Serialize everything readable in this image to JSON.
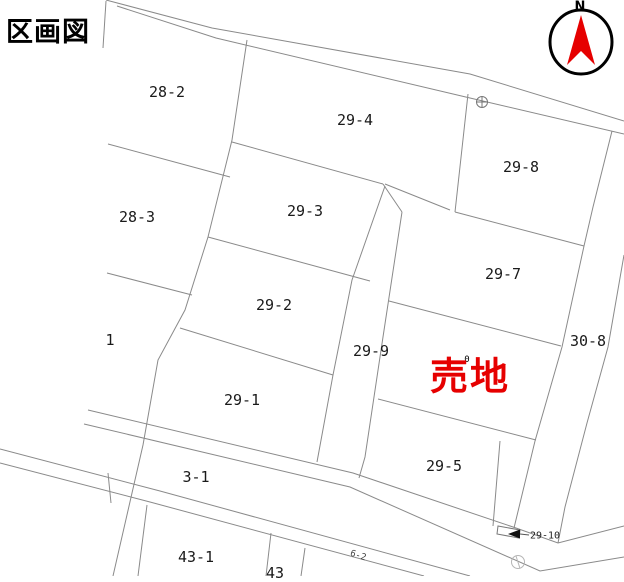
{
  "title": "区画図",
  "compass": {
    "north_label": "N",
    "arrow_color": "#e60000",
    "ring_color": "#000000"
  },
  "sale": {
    "label": "売地",
    "color": "#e60000",
    "hidden_mark": "0"
  },
  "lots": [
    {
      "label": "28-2",
      "x": 167,
      "y": 92
    },
    {
      "label": "29-4",
      "x": 355,
      "y": 120
    },
    {
      "label": "29-8",
      "x": 521,
      "y": 167
    },
    {
      "label": "28-3",
      "x": 137,
      "y": 217
    },
    {
      "label": "29-3",
      "x": 305,
      "y": 211
    },
    {
      "label": "29-7",
      "x": 503,
      "y": 274
    },
    {
      "label": "29-2",
      "x": 274,
      "y": 305
    },
    {
      "label": "1",
      "x": 110,
      "y": 340
    },
    {
      "label": "29-9",
      "x": 371,
      "y": 351
    },
    {
      "label": "30-8",
      "x": 588,
      "y": 341
    },
    {
      "label": "29-1",
      "x": 242,
      "y": 400
    },
    {
      "label": "29-5",
      "x": 444,
      "y": 466
    },
    {
      "label": "3-1",
      "x": 196,
      "y": 477
    },
    {
      "label": "43-1",
      "x": 196,
      "y": 557
    },
    {
      "label": "43",
      "x": 275,
      "y": 573
    }
  ],
  "annotations": [
    {
      "label": "29-10",
      "x": 545,
      "y": 536
    },
    {
      "label": "6-2",
      "x": 358,
      "y": 556
    }
  ],
  "icons": {
    "benchmark_cross": "circle-with-cross survey mark",
    "utility_circle": "light circle mark on road",
    "direction_arrow": "left-pointing arrow marker"
  },
  "colors": {
    "boundary_line": "#8a8a8a",
    "road_line": "#777777",
    "sale_red": "#e60000"
  }
}
